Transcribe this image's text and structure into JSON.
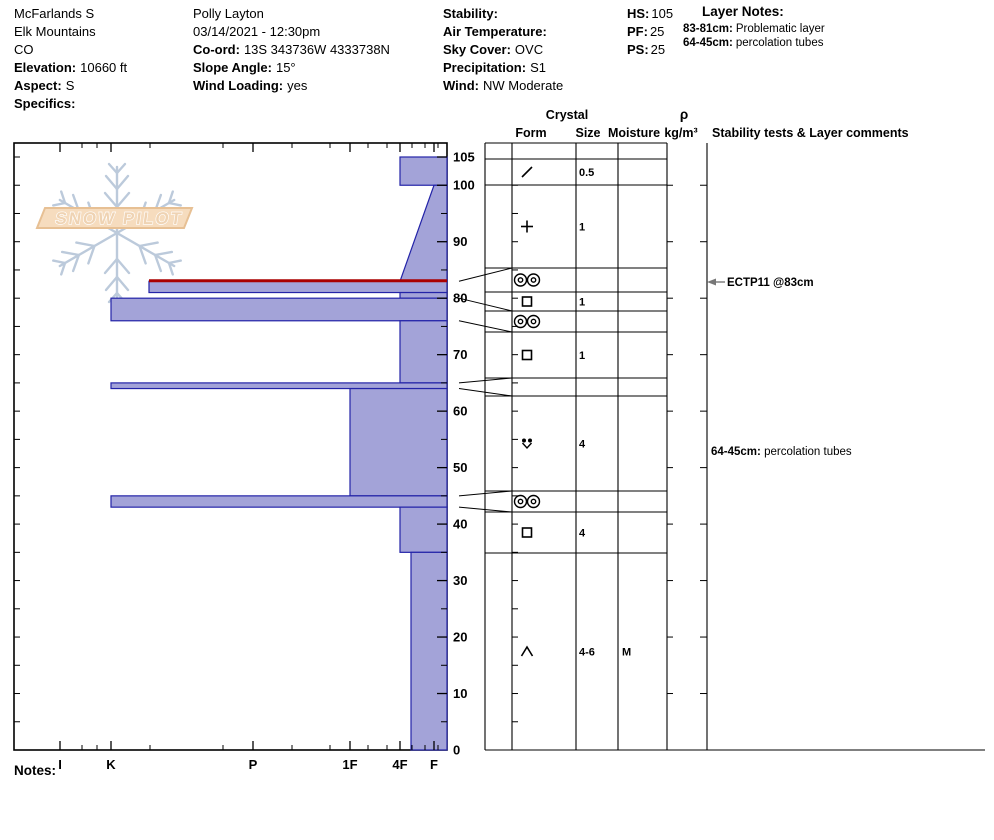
{
  "header": {
    "pit": {
      "name": "McFarlands S",
      "range": "Elk Mountains",
      "state": "CO",
      "elevation_label": "Elevation:",
      "elevation": "10660 ft",
      "aspect_label": "Aspect:",
      "aspect": "S",
      "specifics_label": "Specifics:",
      "specifics": ""
    },
    "observer": {
      "name": "Polly Layton",
      "datetime": "03/14/2021 - 12:30pm",
      "coord_label": "Co-ord:",
      "coord": "13S 343736W 4333738N",
      "slope_angle_label": "Slope Angle:",
      "slope_angle": "15°",
      "wind_loading_label": "Wind Loading:",
      "wind_loading": "yes"
    },
    "conditions": {
      "stability_label": "Stability:",
      "stability": "",
      "air_temperature_label": "Air Temperature:",
      "air_temperature": "",
      "sky_cover_label": "Sky Cover:",
      "sky_cover": "OVC",
      "precipitation_label": "Precipitation:",
      "precipitation": "S1",
      "wind_label": "Wind:",
      "wind": "NW Moderate"
    },
    "totals": {
      "hs_label": "HS:",
      "hs": "105",
      "pf_label": "PF:",
      "pf": "25",
      "ps_label": "PS:",
      "ps": "25"
    },
    "layer_notes": {
      "title": "Layer Notes:",
      "items": [
        {
          "range": "83-81cm:",
          "note": "Problematic layer"
        },
        {
          "range": "64-45cm:",
          "note": "percolation tubes"
        }
      ]
    }
  },
  "logo": {
    "text": "SNOW PILOT"
  },
  "footer": {
    "notes_label": "Notes:"
  },
  "chart_data": {
    "type": "bar",
    "subtype": "snow-profile-hardness",
    "title": "",
    "depth_axis": {
      "unit": "cm",
      "min": 0,
      "max": 105,
      "major_tick_labels": [
        105,
        100,
        90,
        80,
        70,
        60,
        50,
        40,
        30,
        20,
        10,
        0
      ],
      "minor_tick_step": 5
    },
    "hardness_axis": {
      "categories": [
        "I",
        "K",
        "P",
        "1F",
        "4F",
        "F"
      ],
      "note": "hand hardness, harder to the left"
    },
    "columns": {
      "crystal": "Crystal",
      "form": "Form",
      "size": "Size",
      "moisture": "Moisture",
      "density_rho": "ρ",
      "density_units": "kg/m³",
      "comments": "Stability tests & Layer comments"
    },
    "layers": [
      {
        "top_cm": 105,
        "bottom_cm": 100,
        "hardness": "4F",
        "form": "DF",
        "form_name": "decomposing-fragments",
        "size": "0.5",
        "moisture": "",
        "problematic": false
      },
      {
        "top_cm": 100,
        "bottom_cm": 83,
        "hardness": "F-4F",
        "hardness_top": "F",
        "hardness_bottom": "4F",
        "form": "PP",
        "form_name": "precipitation-particles",
        "size": "1",
        "moisture": "",
        "problematic": false
      },
      {
        "top_cm": 83,
        "bottom_cm": 81,
        "hardness": "K-",
        "form": "MFcr",
        "form_name": "melt-freeze-crust",
        "size": "",
        "moisture": "",
        "problematic": true
      },
      {
        "top_cm": 81,
        "bottom_cm": 80,
        "hardness": "4F",
        "form": "FC",
        "form_name": "faceted-crystals",
        "size": "1",
        "moisture": "",
        "problematic": false
      },
      {
        "top_cm": 80,
        "bottom_cm": 76,
        "hardness": "K",
        "form": "MFcr",
        "form_name": "melt-freeze-crust",
        "size": "",
        "moisture": "",
        "problematic": false
      },
      {
        "top_cm": 76,
        "bottom_cm": 65,
        "hardness": "4F",
        "form": "FC",
        "form_name": "faceted-crystals",
        "size": "1",
        "moisture": "",
        "problematic": false
      },
      {
        "top_cm": 65,
        "bottom_cm": 64,
        "hardness": "K",
        "form": "",
        "form_name": "",
        "size": "",
        "moisture": "",
        "problematic": false
      },
      {
        "top_cm": 64,
        "bottom_cm": 45,
        "hardness": "1F",
        "form": "FCxr",
        "form_name": "rounding-faceted-particles",
        "size": "4",
        "moisture": "",
        "problematic": false
      },
      {
        "top_cm": 45,
        "bottom_cm": 43,
        "hardness": "K",
        "form": "MFcr",
        "form_name": "melt-freeze-crust",
        "size": "",
        "moisture": "",
        "problematic": false
      },
      {
        "top_cm": 43,
        "bottom_cm": 35,
        "hardness": "4F",
        "form": "FC",
        "form_name": "faceted-crystals",
        "size": "4",
        "moisture": "",
        "problematic": false
      },
      {
        "top_cm": 35,
        "bottom_cm": 0,
        "hardness": "4F-F",
        "form": "DH",
        "form_name": "depth-hoar",
        "size": "4-6",
        "moisture": "M",
        "problematic": false
      }
    ],
    "stability_tests": [
      {
        "label": "ECTP11 @83cm",
        "depth_cm": 83,
        "y_px": 282
      }
    ],
    "layer_comments": [
      {
        "range": "64-45cm:",
        "text": " percolation tubes",
        "y_px": 451
      }
    ],
    "colors": {
      "bar_fill": "#a3a3d8",
      "bar_stroke": "#2323a8",
      "problematic_layer": "#aa0000",
      "frame": "#000000",
      "logo_flake": "#bccadb",
      "logo_banner_fill": "#f6dcbe",
      "logo_banner_stroke": "#e7c094",
      "logo_text_fill": "#efd3b3"
    },
    "layout": {
      "plot": {
        "left": 14,
        "top": 143,
        "right": 447,
        "bottom": 750
      },
      "surface_top_px": 157,
      "hardness_px": {
        "I": 60,
        "K": 111,
        "K-": 149,
        "P": 253,
        "1F": 350,
        "4F": 400,
        "4F-F": 411,
        "F": 434
      },
      "hardness_minor_ticks_px": [
        82,
        97,
        150,
        223,
        292,
        330,
        368,
        387,
        412,
        425,
        438
      ],
      "table_cols_px": [
        485,
        512,
        576,
        618,
        667,
        707
      ],
      "table_bottom_right_px": 985,
      "row_boundaries_px": [
        143,
        159,
        185,
        268,
        292,
        311,
        332,
        378,
        396,
        491,
        512,
        553,
        750
      ],
      "row_boundary_depths": [
        null,
        105,
        100,
        83,
        81,
        80,
        76,
        65,
        64,
        45,
        43,
        35,
        0
      ]
    }
  }
}
